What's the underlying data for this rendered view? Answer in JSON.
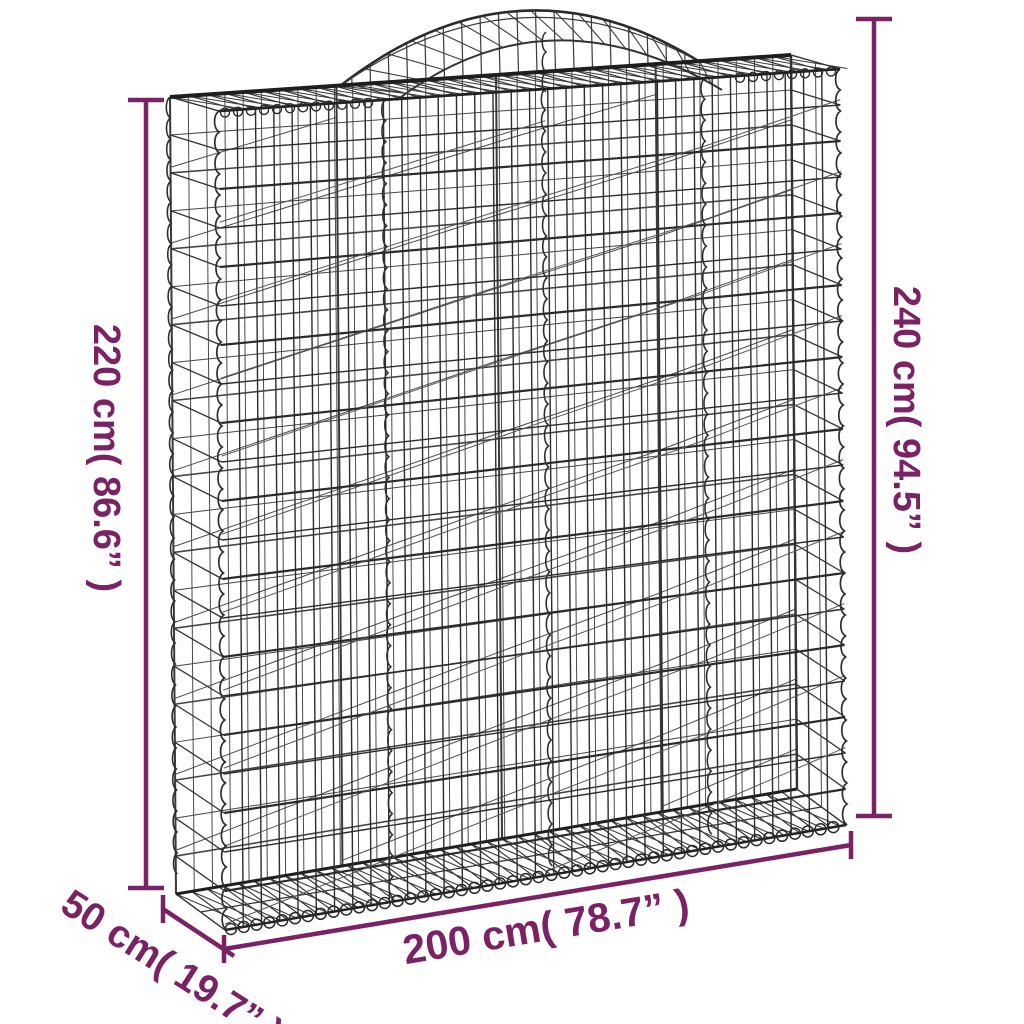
{
  "diagram": {
    "type": "product-dimension-diagram",
    "subject": "Arched gabion wire mesh basket",
    "background_color": "#ffffff",
    "accent_color": "#7A2264",
    "wire_color": "#2e2e2e",
    "dimensions": {
      "height_left": {
        "label": "220 cm( 86.6” )",
        "value_cm": "220 cm",
        "value_in": "86.6”"
      },
      "height_right": {
        "label": "240 cm( 94.5” )",
        "value_cm": "240 cm",
        "value_in": "94.5”"
      },
      "width": {
        "label": "200 cm( 78.7” )",
        "value_cm": "200 cm",
        "value_in": "78.7”"
      },
      "depth": {
        "label": "50 cm( 19.7” )",
        "value_cm": "50 cm",
        "value_in": "19.7”"
      }
    }
  }
}
